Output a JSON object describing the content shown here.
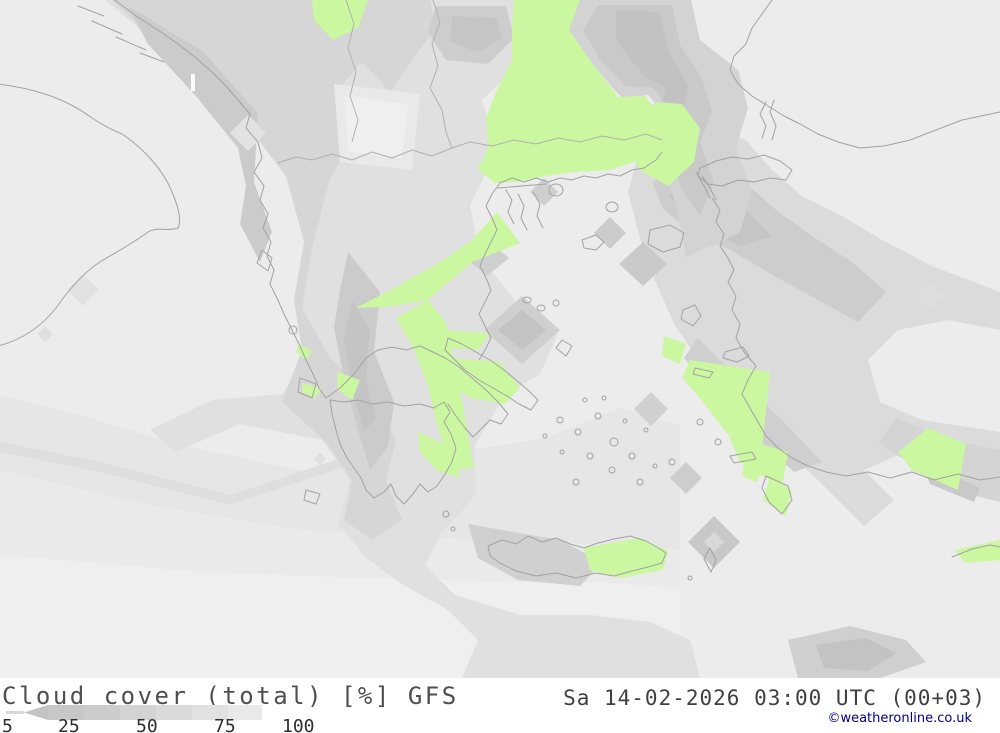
{
  "legend": {
    "title": "Cloud cover (total) [%]",
    "model": "GFS",
    "datetime": "Sa 14-02-2026 03:00 UTC (00+03)",
    "copyright": "©weatheronline.co.uk",
    "scale_ticks": [
      "5",
      "25",
      "50",
      "75",
      "100"
    ],
    "scale_unit": "%"
  },
  "colors": {
    "background_gray": "#ececec",
    "cloud_dark_gray": "#c2c2c2",
    "clear_sky_green": "#cbf7a0",
    "coastline_gray": "#a2a2a2",
    "copyright_blue": "#00008b"
  }
}
